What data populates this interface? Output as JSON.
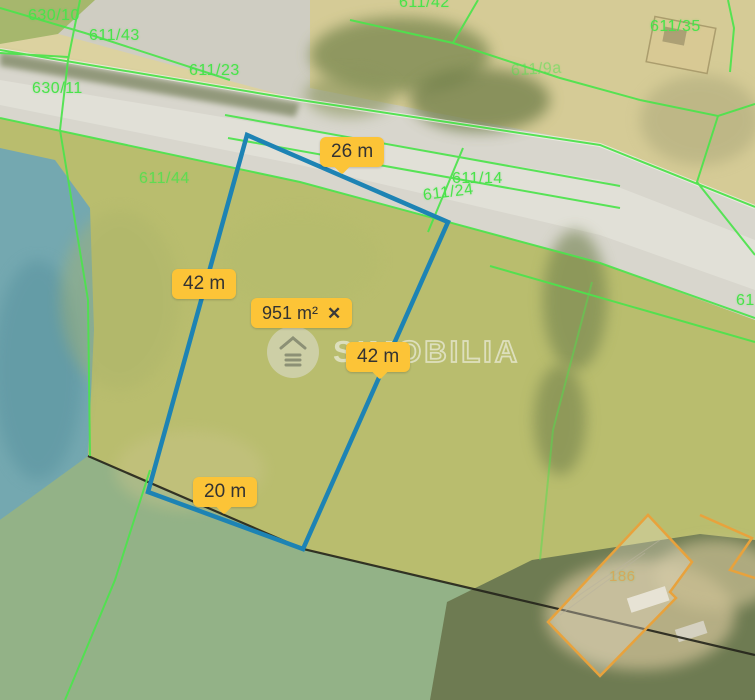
{
  "map": {
    "parcel_labels": [
      {
        "text": "630/10"
      },
      {
        "text": "611/43"
      },
      {
        "text": "611/23"
      },
      {
        "text": "630/11"
      },
      {
        "text": "611/42"
      },
      {
        "text": "611/35"
      },
      {
        "text": "611/44"
      },
      {
        "text": "611/9a"
      },
      {
        "text": "611/14"
      },
      {
        "text": "611/24"
      },
      {
        "text": "61"
      },
      {
        "text": "186"
      }
    ],
    "measurement_labels": [
      {
        "side": "top",
        "text": "26 m"
      },
      {
        "side": "left",
        "text": "42 m"
      },
      {
        "side": "right",
        "text": "42 m"
      },
      {
        "side": "bottom",
        "text": "20 m"
      }
    ],
    "area_label": {
      "text": "951 m²",
      "close_icon": "✕"
    },
    "watermark": {
      "brand_bold": "SIM",
      "brand_light": "OBILIA"
    },
    "colors": {
      "measurement_line": "#1d83b4",
      "label_background": "#fcc437",
      "cadastral_line": "#4ce44c",
      "building_outline": "#e8a23c",
      "water": "#74a8b0"
    }
  }
}
